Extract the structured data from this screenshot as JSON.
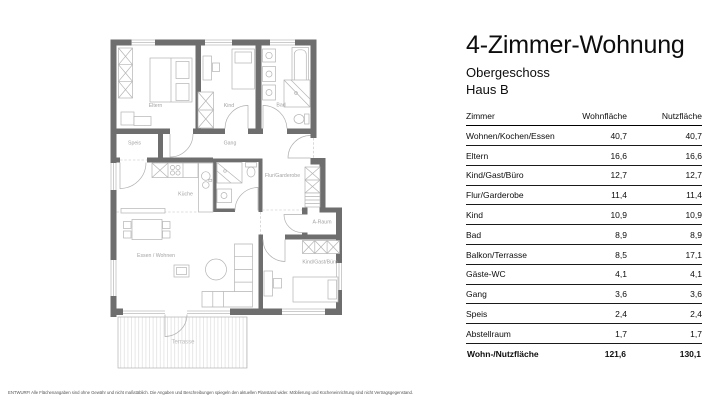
{
  "header": {
    "title": "4-Zimmer-Wohnung",
    "subtitle": "Obergeschoss",
    "building": "Haus B"
  },
  "table": {
    "columns": [
      "Zimmer",
      "Wohnfläche",
      "Nutzfläche"
    ],
    "rows": [
      {
        "name": "Wohnen/Kochen/Essen",
        "wohnflaeche": "40,7",
        "nutzflaeche": "40,7"
      },
      {
        "name": "Eltern",
        "wohnflaeche": "16,6",
        "nutzflaeche": "16,6"
      },
      {
        "name": "Kind/Gast/Büro",
        "wohnflaeche": "12,7",
        "nutzflaeche": "12,7"
      },
      {
        "name": "Flur/Garderobe",
        "wohnflaeche": "11,4",
        "nutzflaeche": "11,4"
      },
      {
        "name": "Kind",
        "wohnflaeche": "10,9",
        "nutzflaeche": "10,9"
      },
      {
        "name": "Bad",
        "wohnflaeche": "8,9",
        "nutzflaeche": "8,9"
      },
      {
        "name": "Balkon/Terrasse",
        "wohnflaeche": "8,5",
        "nutzflaeche": "17,1"
      },
      {
        "name": "Gäste-WC",
        "wohnflaeche": "4,1",
        "nutzflaeche": "4,1"
      },
      {
        "name": "Gang",
        "wohnflaeche": "3,6",
        "nutzflaeche": "3,6"
      },
      {
        "name": "Speis",
        "wohnflaeche": "2,4",
        "nutzflaeche": "2,4"
      },
      {
        "name": "Abstellraum",
        "wohnflaeche": "1,7",
        "nutzflaeche": "1,7"
      }
    ],
    "total": {
      "name": "Wohn-/Nutzfläche",
      "wohnflaeche": "121,6",
      "nutzflaeche": "130,1"
    }
  },
  "plan": {
    "rooms": {
      "eltern": "Eltern",
      "kind": "Kind",
      "bad": "Bad",
      "speis": "Speis",
      "gang": "Gang",
      "kueche": "Küche",
      "flur": "Flur/Garderobe",
      "a_raum": "A-Raum",
      "kind_gast_buero": "Kind/Gast/Büro",
      "essen_wohnen": "Essen / Wohnen",
      "terrasse": "Terrasse"
    },
    "colors": {
      "wall": "#6e6e6e",
      "furniture": "#b4b4b4",
      "label": "#a3a3a3"
    }
  },
  "disclaimer": "ENTWURF! Alle Flächenangaben sind ohne Gewähr und nicht maßstäblich. Die Angaben und Beschreibungen spiegeln den aktuellen Planstand wider. Möblierung und Kücheneinrichtung sind nicht Vertragsgegenstand."
}
